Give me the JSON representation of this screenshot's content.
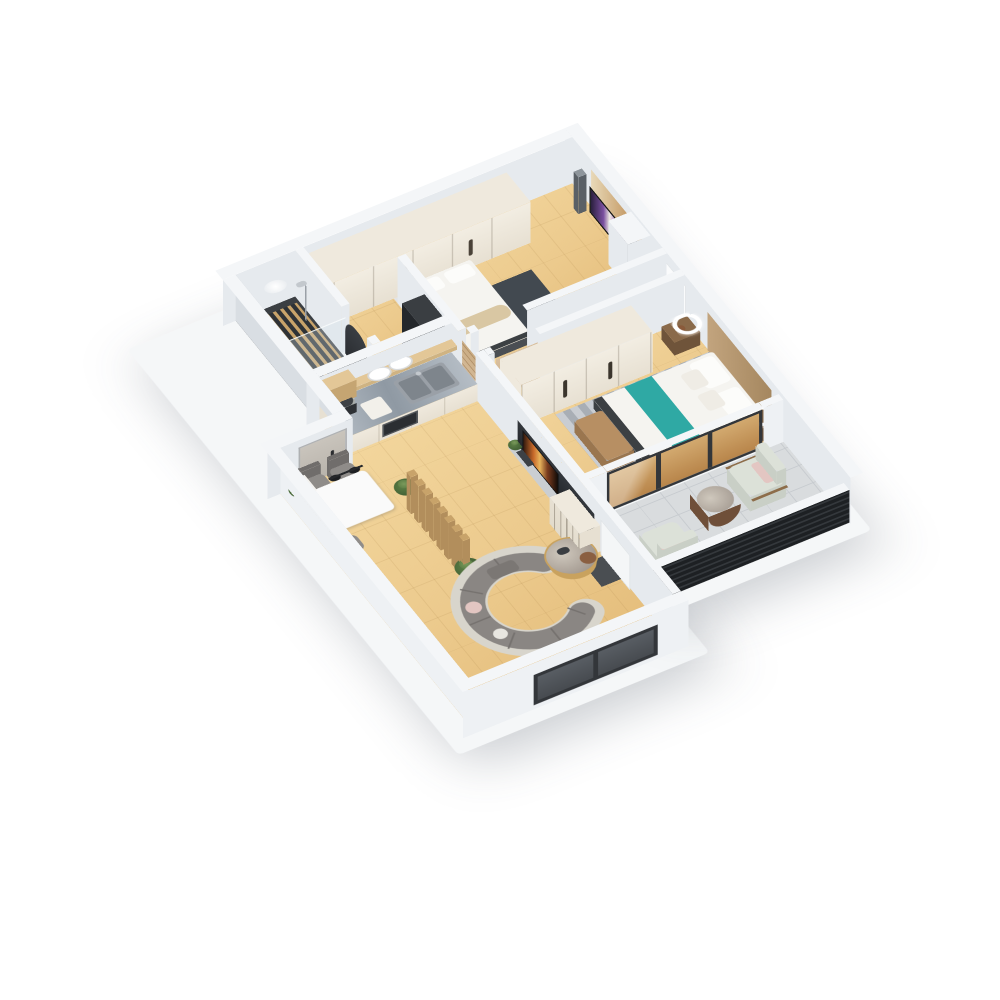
{
  "scene": {
    "description": "3D isometric cutaway render of an apartment floor plan, viewed from above; no visible text in image",
    "background": "#ffffff",
    "camera": {
      "projection": "axonometric",
      "rotate_x_deg": 45,
      "rotate_z_deg": -30
    },
    "palette": {
      "wall_top": "#f4f6f8",
      "wall_face_ext": "#eef1f4",
      "wall_face_int": "#e6eaee",
      "wall_face_shade": "#d9dee3",
      "slab": "#f5f7f8",
      "floor_wood": "#ecca8d",
      "floor_wood_hi": "#f3d79e",
      "floor_wood_lo": "#e3bb78",
      "plank_line": "rgba(160,120,60,0.14)",
      "floor_tile": "#d9dcde",
      "tile_line": "#c7cbcf",
      "bath_floor": "#3b3f43",
      "slat_wood": "#c8a36a",
      "cabinet_cream": "#efe9dd",
      "cabinet_face": "#e7e0d2",
      "counter_marble_a": "#b6bec6",
      "counter_marble_b": "#8f99a3",
      "shelf_wood": "#e3c797",
      "sofa_gray": "#8a8683",
      "sofa_gray_dark": "#76726f",
      "sofa_cream": "#d8d5cc",
      "teal": "#2fa9a4",
      "bed_white": "#f5f4f0",
      "pillow_white": "#fcfcfa",
      "blanket_beige": "#d9c7a3",
      "bench_brown": "#b78f63",
      "bench_brown_dark": "#9a764f",
      "bed_frame_dark": "#3c4043",
      "rug_dark": "#424950",
      "rug_stripe_a": "#c9cdd2",
      "rug_stripe_b": "#a8aeb5",
      "louver_dark": "#1d2023",
      "louver_lit": "#34383c",
      "frame_dark": "#33363a",
      "glass_pane": "#585d63",
      "glass_tan_a": "#d2a96f",
      "glass_tan_b": "#b8854a",
      "plant_green_a": "#5d7f46",
      "plant_green_b": "#3f5d33",
      "chair_gray": "#8f8c89",
      "chair_gray_dark": "#706d6b",
      "balcony_chair": "#dce1d8",
      "balcony_chair_face": "#c9cfc6",
      "pillow_pink": "#e3c6c2",
      "table_white": "#fafafa",
      "wood_door": "#d9c0a0",
      "door_greige": "#c9c4bc",
      "tv_dark": "#101214",
      "gold": "#c9a25e",
      "marble_table_a": "#cfc8bd",
      "marble_table_b": "#9d938a",
      "lamp_white": "#ffffff",
      "lamp_brown": "#8a5a3a",
      "steel": "#9aa0a7",
      "steel_dark": "#7e858c",
      "appliance_dark": "#34383c"
    },
    "rooms": [
      {
        "id": "bathroom",
        "label": "bathroom with walk-in shower"
      },
      {
        "id": "closet-corridor",
        "label": "walk-through closet corridor"
      },
      {
        "id": "bedroom-2",
        "label": "second bedroom with tv"
      },
      {
        "id": "hallway",
        "label": "hallway"
      },
      {
        "id": "master-bedroom",
        "label": "master bedroom with teal bed"
      },
      {
        "id": "balcony",
        "label": "balcony with lounge chairs"
      },
      {
        "id": "kitchen",
        "label": "open kitchen with island counter"
      },
      {
        "id": "living-dining",
        "label": "living and dining room"
      },
      {
        "id": "entry",
        "label": "entry"
      }
    ],
    "furniture": [
      "curved-sectional-sofa",
      "round-coffee-table",
      "tv-media-wall",
      "dining-table",
      "dining-chair",
      "pendant-lamp",
      "wood-slat-partition",
      "potted-plant",
      "kitchen-counter",
      "double-sink",
      "wall-shelf",
      "plates",
      "microwave",
      "fridge",
      "wardrobe",
      "double-bed",
      "teal-runner",
      "pillow",
      "bed-bench",
      "nightstand",
      "table-lamp",
      "striped-rug",
      "dark-rug",
      "tv-screen",
      "speaker-stand",
      "shower-glass",
      "shower-column",
      "toilet",
      "slat-mat",
      "ceiling-lamp",
      "balcony-armchair",
      "balcony-side-table",
      "louver-railing",
      "window",
      "door"
    ]
  }
}
